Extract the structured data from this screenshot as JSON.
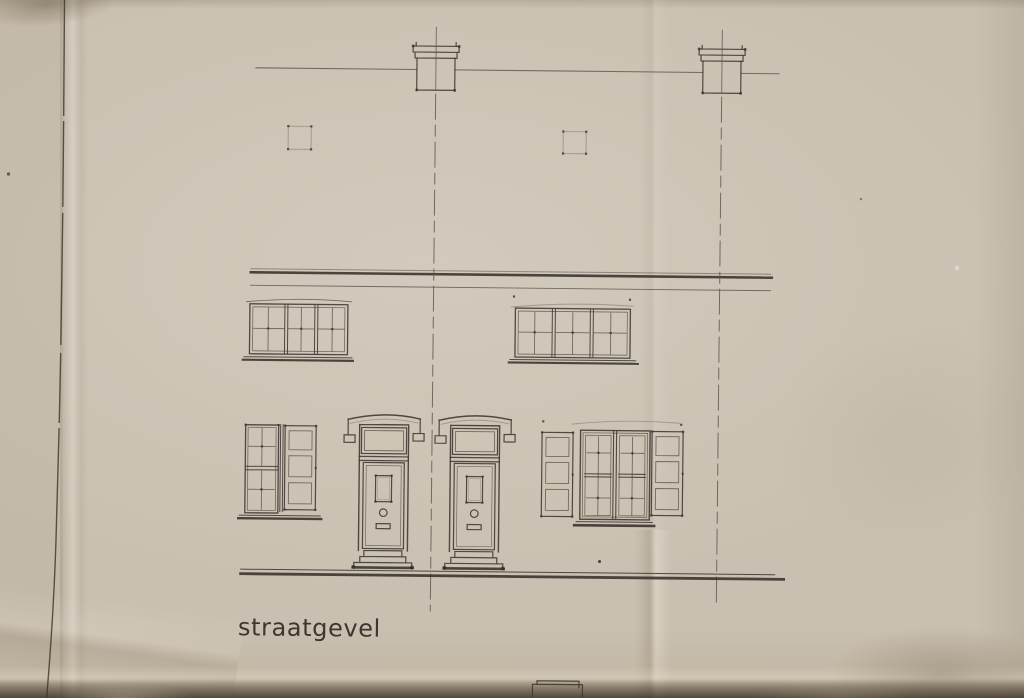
{
  "document": {
    "caption": "straatgevel",
    "description": "ink street-facade elevation drawing of two attached houses on aged folded paper"
  },
  "colors": {
    "paper": "#c9c0b1",
    "paper_highlight": "#d6cec0",
    "paper_left_strip": "#c1b5a3",
    "bottom_shadow": "#4a3d2c",
    "ink_dark": "#3d3731",
    "ink_medium": "#5a5248",
    "ink_faint": "#8a7e6e"
  },
  "drawing": {
    "elements": [
      "roof-line",
      "chimney-left",
      "chimney-right",
      "attic-window-left",
      "attic-window-right",
      "eaves-band",
      "upper-window-left",
      "upper-window-right",
      "ground-window-left",
      "shutter-ground-left",
      "door-left",
      "door-right",
      "ground-window-right",
      "shutter-ground-right-1",
      "shutter-ground-right-2",
      "party-wall-line-left",
      "party-wall-line-right",
      "ground-line",
      "step-detail-bottom",
      "left-margin-line"
    ]
  }
}
